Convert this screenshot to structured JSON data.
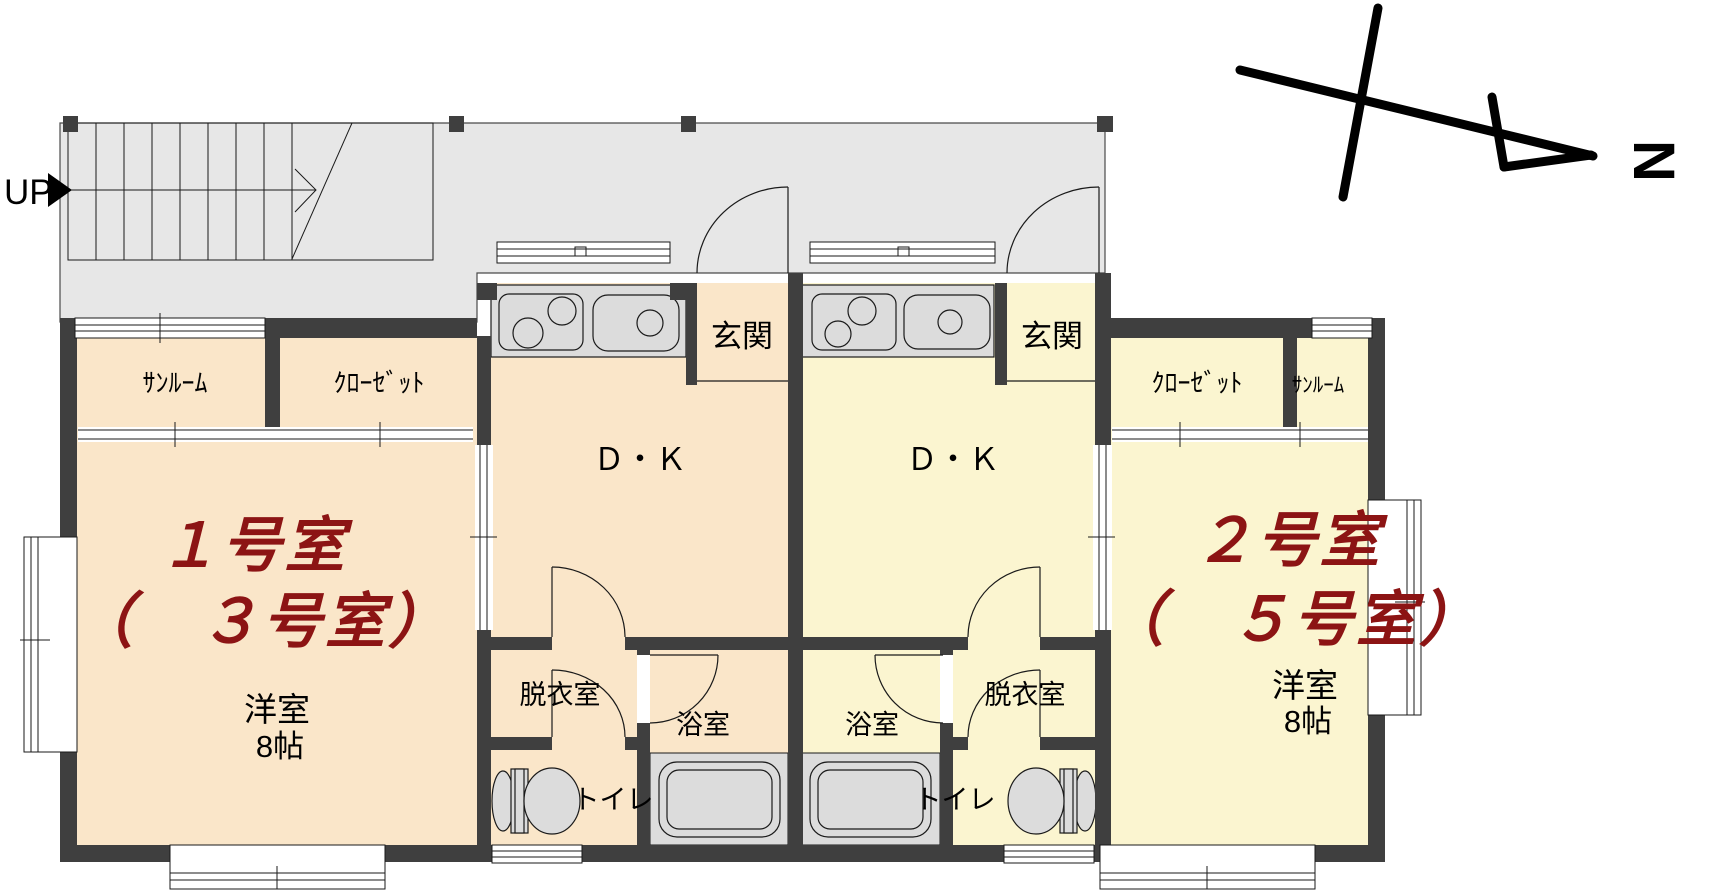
{
  "compass": {
    "north_label": "N"
  },
  "stairs": {
    "up_label": "UP"
  },
  "colors": {
    "wall": "#3f3f3f",
    "corridor_fill": "#e7e7e7",
    "left_unit_fill": "#fae6c9",
    "right_unit_fill": "#fbf5d0",
    "fixture_fill": "#dcdcdc",
    "unit_number_color": "#8c1414"
  },
  "left_unit": {
    "unit_number": "１号室",
    "alt_unit_number": "（　３号室）",
    "room_type": "洋室",
    "room_size": "8帖",
    "sunroom": "ｻﾝﾙｰﾑ",
    "closet": "ｸﾛｰｾﾞｯﾄ",
    "dining_kitchen": "Ｄ・Ｋ",
    "entrance": "玄関",
    "dressing_room": "脱衣室",
    "bathroom": "浴室",
    "toilet": "トイレ"
  },
  "right_unit": {
    "unit_number": "２号室",
    "alt_unit_number": "（　５号室）",
    "room_type": "洋室",
    "room_size": "8帖",
    "sunroom": "ｻﾝﾙｰﾑ",
    "closet": "ｸﾛｰｾﾞｯﾄ",
    "dining_kitchen": "Ｄ・Ｋ",
    "entrance": "玄関",
    "dressing_room": "脱衣室",
    "bathroom": "浴室",
    "toilet": "トイレ"
  }
}
